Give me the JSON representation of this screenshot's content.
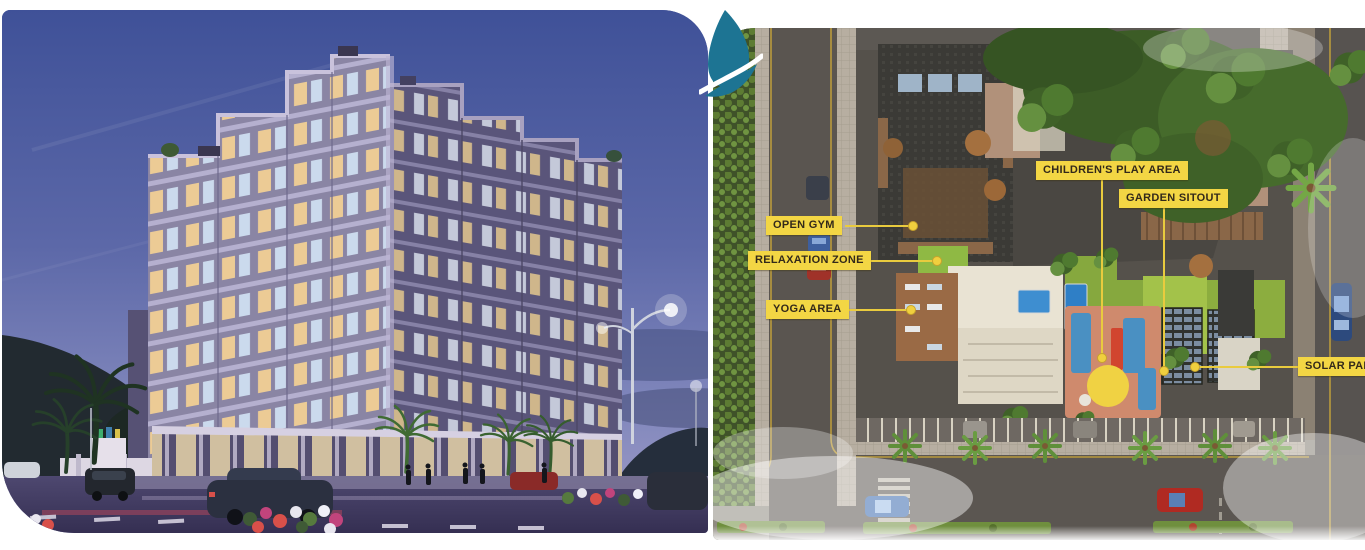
{
  "meta": {
    "description": "Real-estate brochure spread: night exterior render of an apartment tower on the left, annotated aerial amenity site-plan on the right"
  },
  "logo": {
    "name": "leaf-logo",
    "color": "#1d7493"
  },
  "left_panel": {
    "name": "building-night-render"
  },
  "right_panel": {
    "name": "aerial-site-plan",
    "label_bg": "#f3d644",
    "label_text_color": "#33291a",
    "leader_color": "#e9cb3e",
    "labels": [
      {
        "text": "OPEN GYM"
      },
      {
        "text": "RELAXATION ZONE"
      },
      {
        "text": "YOGA AREA"
      },
      {
        "text": "CHILDREN'S PLAY AREA"
      },
      {
        "text": "GARDEN SITOUT"
      },
      {
        "text": "SOLAR PANEL"
      }
    ]
  }
}
